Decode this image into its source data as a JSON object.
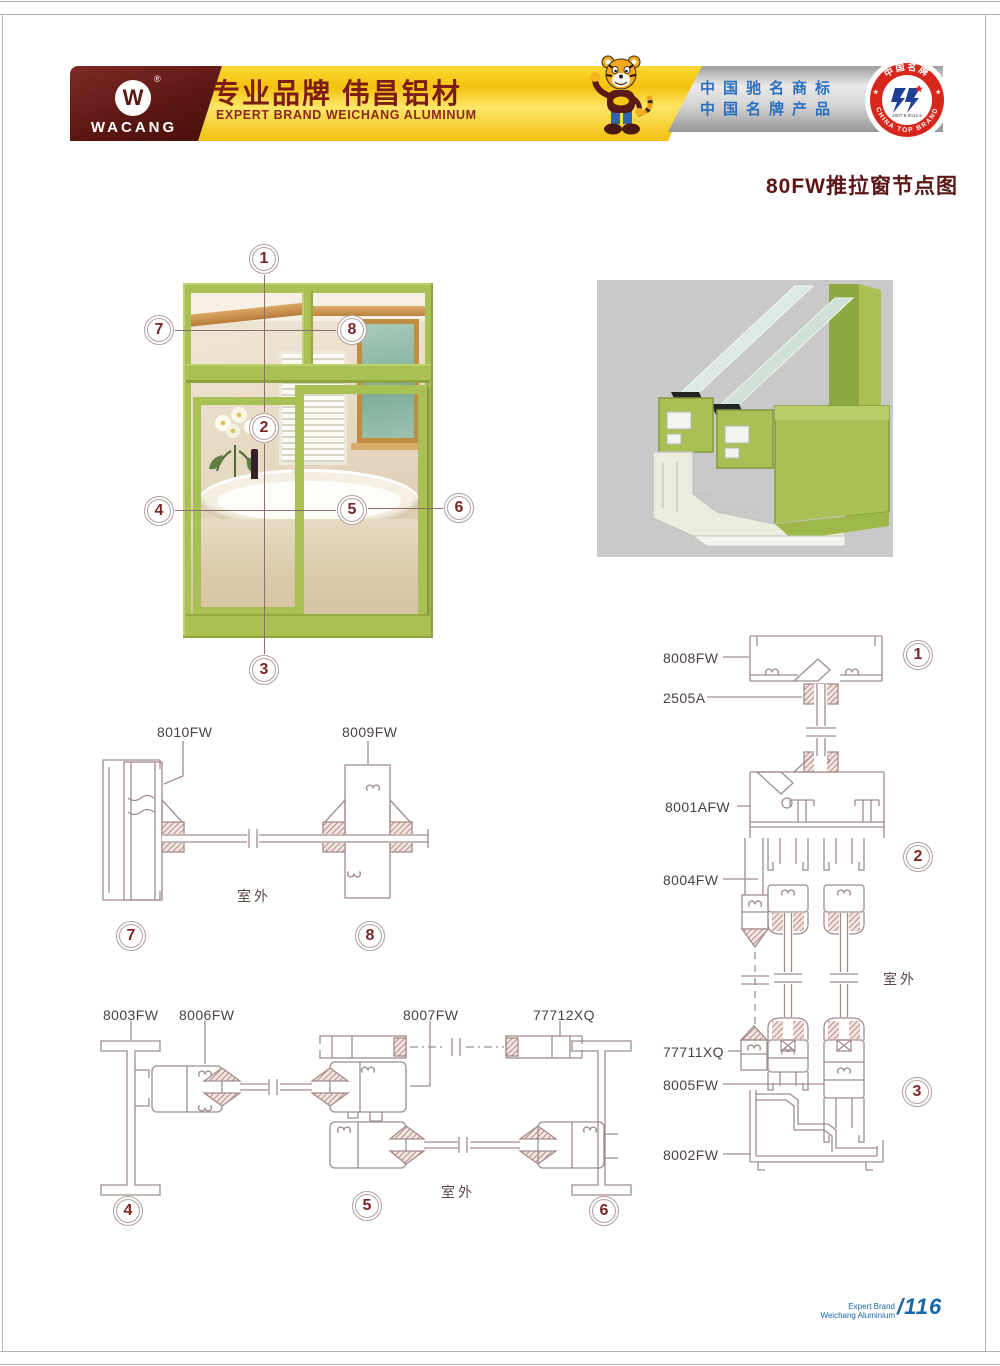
{
  "header": {
    "logo": {
      "monogram": "W",
      "reg": "®",
      "text": "WACANG"
    },
    "brand_cn": "专业品牌  伟昌铝材",
    "brand_en": "EXPERT BRAND WEICHANG ALUMINUM",
    "honor_line1": "中国驰名商标",
    "honor_line2": "中国名牌产品",
    "seal": {
      "top": "中国名牌",
      "bottom": "CHINA TOP BRAND",
      "years": "2007.9-2012.9",
      "star": "★"
    }
  },
  "title": "80FW推拉窗节点图",
  "photo": {
    "callouts": [
      "1",
      "2",
      "3",
      "4",
      "5",
      "6",
      "7",
      "8"
    ]
  },
  "sections": {
    "d78": {
      "parts": [
        "8010FW",
        "8009FW"
      ],
      "outdoor": "室外",
      "c7": "7",
      "c8": "8"
    },
    "d456": {
      "parts": [
        "8003FW",
        "8006FW",
        "8007FW",
        "77712XQ"
      ],
      "outdoor": "室外",
      "c4": "4",
      "c5": "5",
      "c6": "6"
    },
    "d123": {
      "parts": [
        "8008FW",
        "2505A",
        "8001AFW",
        "8004FW",
        "77711XQ",
        "8005FW",
        "8002FW"
      ],
      "outdoor": "室外",
      "c1": "1",
      "c2": "2",
      "c3": "3"
    }
  },
  "footer": {
    "brand_line1": "Expert Brand",
    "brand_line2": "Weichang Aluminium",
    "page_number": "/116"
  },
  "colors": {
    "frame_green": "#a9c054",
    "accent_maroon": "#5c1616",
    "brand_gold": "#f4c20d",
    "honor_blue": "#2a6fc0",
    "diagram_line": "#a18c8c",
    "footer_blue": "#1566b0"
  }
}
